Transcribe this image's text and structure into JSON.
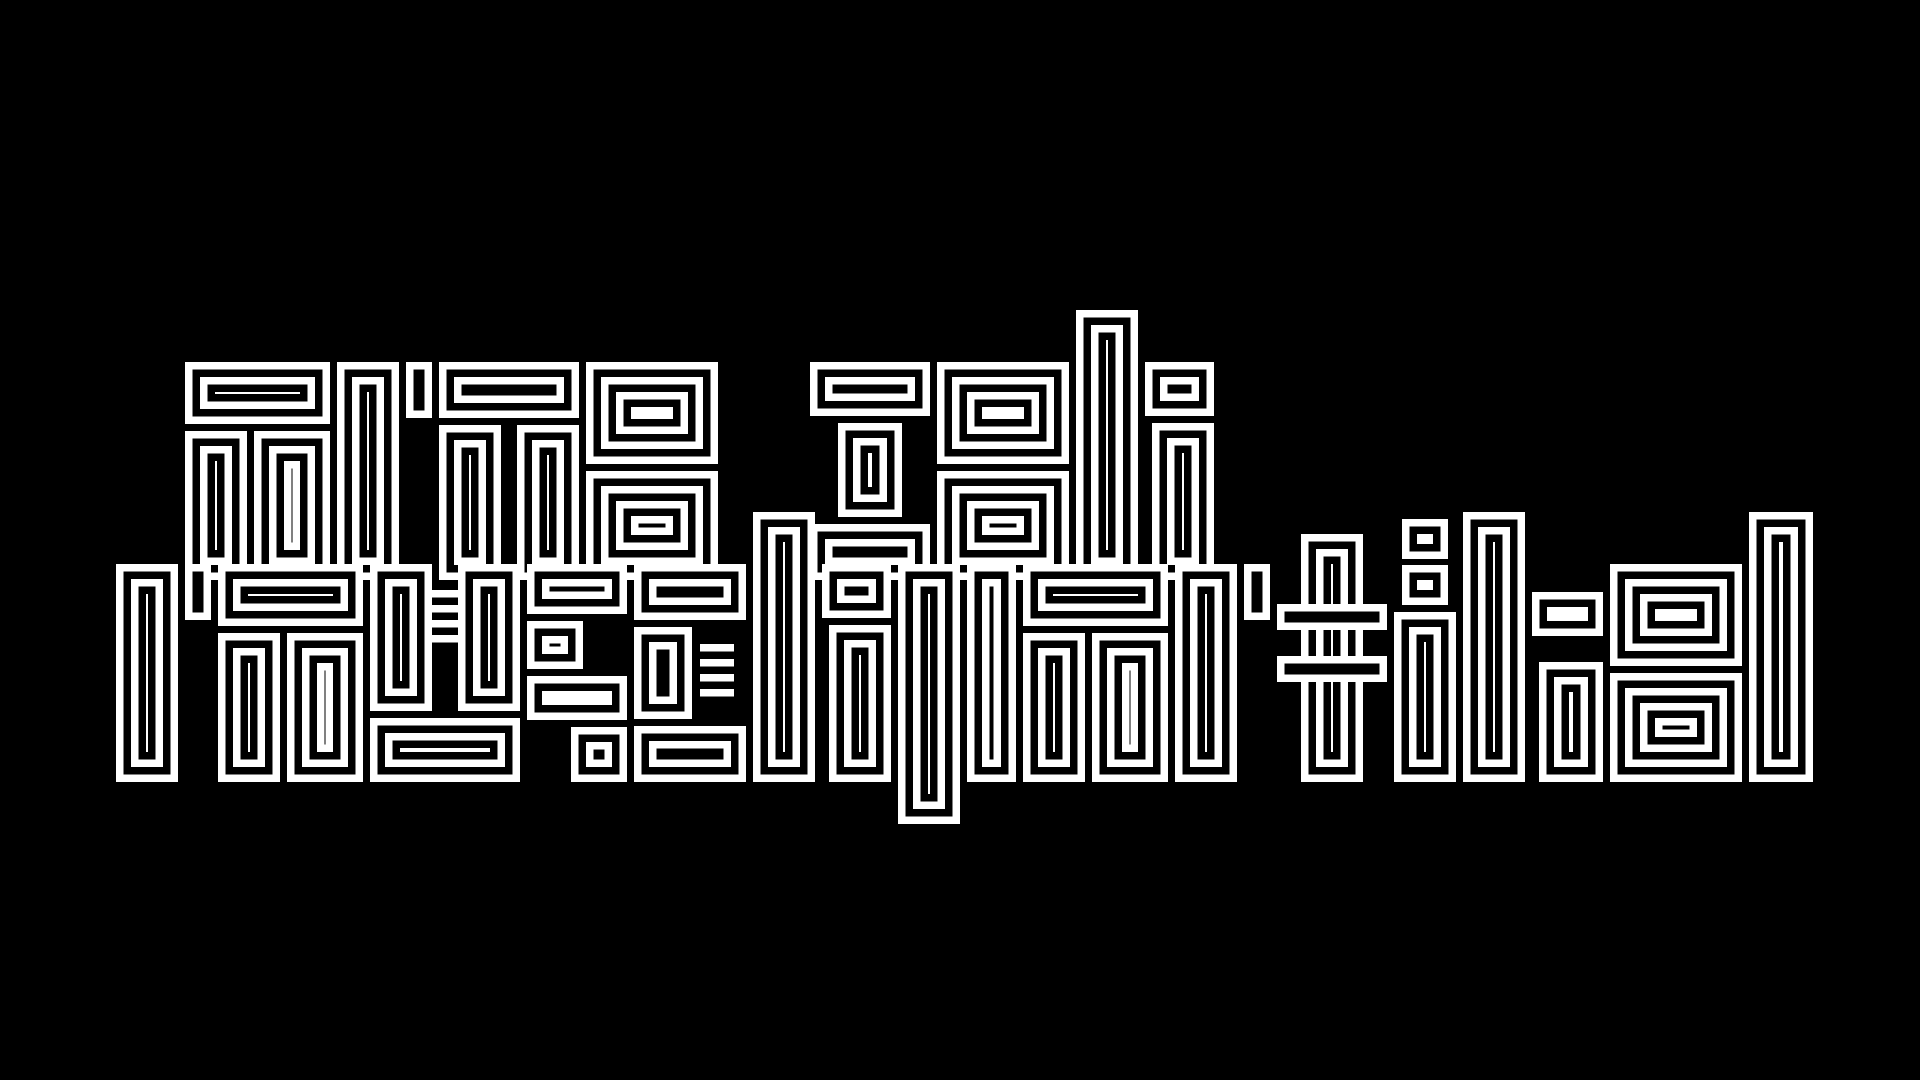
{
  "artwork": {
    "full_text": "arne zeh rauschpartikel",
    "lines": [
      {
        "text": "arne zeh"
      },
      {
        "text": "rauschpartikel"
      }
    ],
    "style": "rectangular labyrinth op-art lettering, concentric stripes",
    "colors": {
      "background": "#000000",
      "lines": "#ffffff"
    }
  }
}
